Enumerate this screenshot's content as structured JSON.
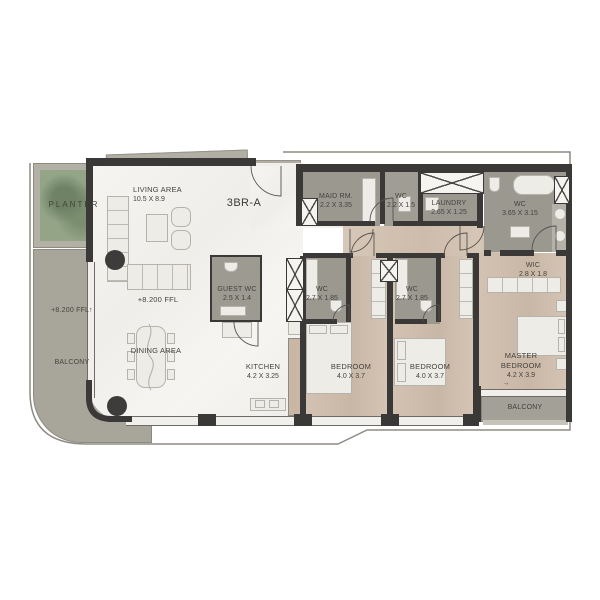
{
  "plan": {
    "title": "3BR-A",
    "rooms": {
      "living": {
        "name": "LIVING AREA",
        "dims": "10.5 X 8.9"
      },
      "dining": {
        "name": "DINING AREA"
      },
      "kitchen": {
        "name": "KITCHEN",
        "dims": "4.2 X 3.25"
      },
      "guest_wc": {
        "name": "GUEST WC",
        "dims": "2.5 X 1.4"
      },
      "maid": {
        "name": "MAID RM.",
        "dims": "2.2 X 3.35"
      },
      "maid_wc": {
        "name": "WC",
        "dims": "2.2 X 1.5"
      },
      "laundry": {
        "name": "LAUNDRY",
        "dims": "2.65 X 1.25"
      },
      "master_wc": {
        "name": "WC",
        "dims": "3.65 X 3.15"
      },
      "wic": {
        "name": "WIC",
        "dims": "2.8 X 1.8"
      },
      "wc_bed1": {
        "name": "WC",
        "dims": "2.7 X 1.85"
      },
      "wc_bed2": {
        "name": "WC",
        "dims": "2.7 X 1.85"
      },
      "bedroom1": {
        "name": "BEDROOM",
        "dims": "4.0 X 3.7"
      },
      "bedroom2": {
        "name": "BEDROOM",
        "dims": "4.0 X 3.7"
      },
      "master": {
        "name": "MASTER BEDROOM",
        "dims": "4.2 X 3.9"
      },
      "balcony_left": {
        "name": "BALCONY"
      },
      "balcony_right": {
        "name": "BALCONY"
      },
      "planter": {
        "name": "PLANTER"
      }
    },
    "annotations": {
      "ffl": "+8.200 FFL",
      "up_arrow": "↑",
      "right_arrow": "→"
    },
    "colors": {
      "wall": "#3a3937",
      "wood_floor": "#d2c1b1",
      "grey_room": "#9b988f",
      "balcony_grey": "#a8a59b",
      "planter_green": "#8da284",
      "living_marble": "#f4f3f0"
    }
  }
}
